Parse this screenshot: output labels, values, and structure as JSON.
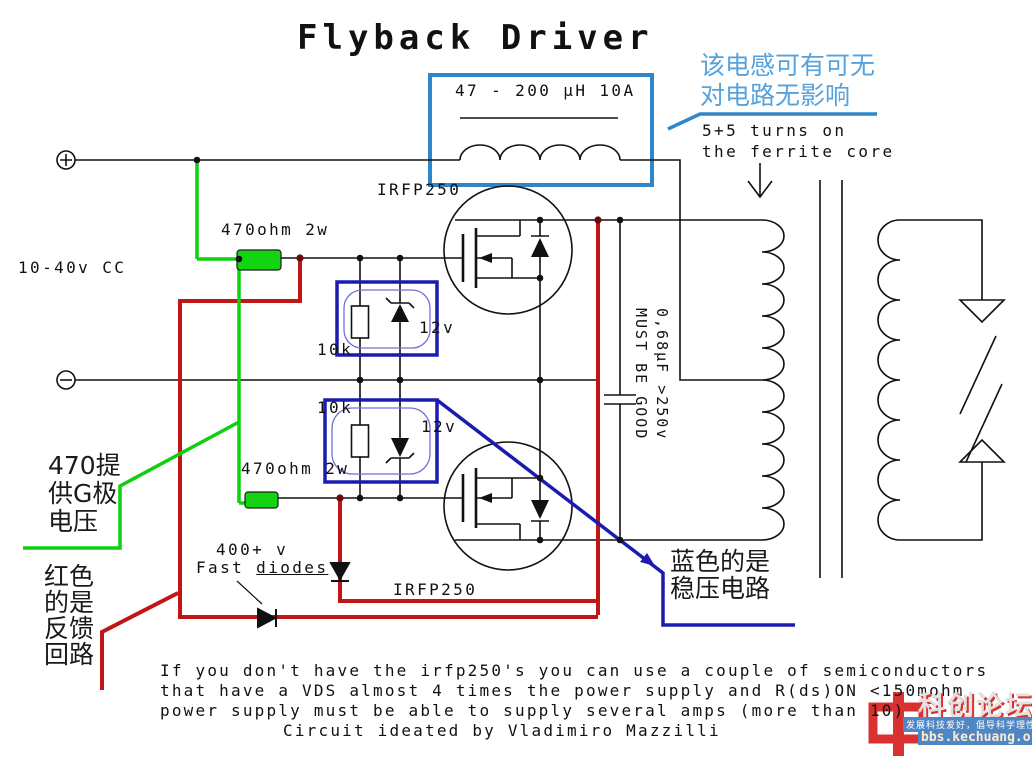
{
  "title": "Flyback Driver",
  "schematic": {
    "inductor_label": "47 - 200 μH 10A",
    "supply_label": "10-40v CC",
    "mosfet_top_label": "IRFP250",
    "mosfet_bottom_label": "IRFP250",
    "gate_resistor_top": "470ohm 2w",
    "gate_resistor_bottom": "470ohm 2w",
    "r10k_top": "10k",
    "r10k_bottom": "10k",
    "zener_top": "12v",
    "zener_bottom": "12v",
    "cap_line1": "0,68μF >250v",
    "cap_line2": "MUST BE GOOD",
    "fast_diode_volts": "400+ v",
    "fast_diode_word1": "Fast ",
    "fast_diode_word2": "diodes",
    "turns_line1": "5+5 turns on",
    "turns_line2": "the ferrite core"
  },
  "annotations": {
    "inductor_cn_line1": "该电感可有可无",
    "inductor_cn_line2": "对电路无影响",
    "gate_cn": [
      "470提",
      "供G极",
      "电压"
    ],
    "feedback_cn": [
      "红色",
      "的是",
      "反馈",
      "回路"
    ],
    "regulator_cn_line1": "蓝色的是",
    "regulator_cn_line2": "稳压电路"
  },
  "notes": {
    "line1": "If you don't have the irfp250's you can use a couple of semiconductors",
    "line2": "that have a VDS almost 4 times the power supply and R(ds)ON <150mohm",
    "line3": "power supply must be able to supply several amps (more than 10)",
    "line4": "Circuit ideated by Vladimiro Mazzilli"
  },
  "watermark": {
    "site_name": "科创论坛",
    "slogan": "发展科技爱好，倡导科学理性",
    "url": "bbs.kechuang.org"
  },
  "colors": {
    "wire_black": "#111111",
    "feedback_red": "#c11616",
    "gate_green": "#0fcf0f",
    "regulator_navy": "#1b1bb0",
    "inductor_blue": "#2f87ca",
    "cn_blue": "#56a2dc",
    "watermark_blue": "#4f86c6",
    "watermark_red": "#d93030"
  }
}
